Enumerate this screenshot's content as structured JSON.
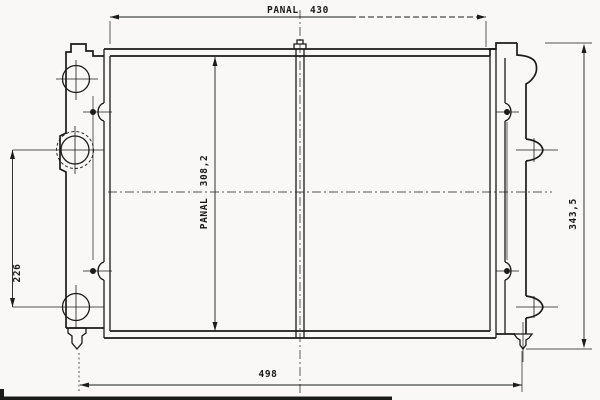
{
  "colors": {
    "line": "#1b1b1b",
    "background": "#f9f8f6"
  },
  "drawing": {
    "labels": {
      "panel_width": "PANAL 430",
      "panel_height": "PANAL 308,2",
      "fitting_spacing": "226",
      "overall_height": "343,5",
      "overall_width": "498"
    }
  }
}
